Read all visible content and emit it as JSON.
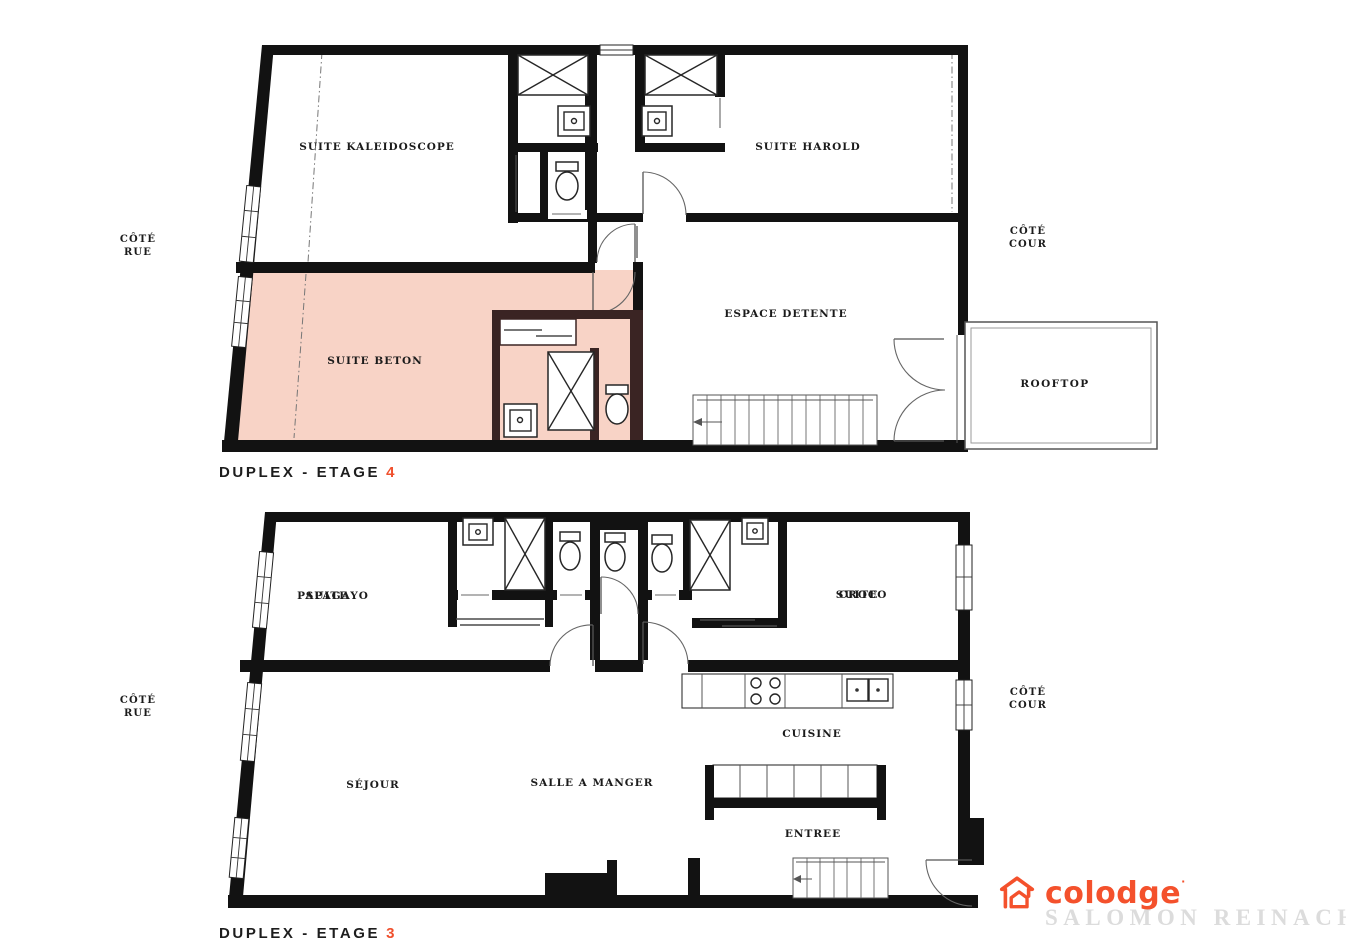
{
  "colors": {
    "accent": "#F0502D",
    "suite_highlight": "#F8D3C6",
    "beton_label": "#E84F35",
    "suite_name_accent": "#7B2025",
    "logo_orange": "#F4512C",
    "residence_gray": "#DCDCDC"
  },
  "floor4": {
    "title_prefix": "DUPLEX - ETAGE",
    "title_number": "4",
    "side_left_line1": "CÔTÉ",
    "side_left_line2": "RUE",
    "side_right_line1": "CÔTÉ",
    "side_right_line2": "COUR",
    "rooms": {
      "kaleidoscope": "SUITE KALEIDOSCOPE",
      "harold": "SUITE HAROLD",
      "beton": "SUITE BETON",
      "espace_detente": "ESPACE DETENTE",
      "rooftop": "ROOFTOP"
    }
  },
  "floor3": {
    "title_prefix": "DUPLEX - ETAGE",
    "title_number": "3",
    "side_left_line1": "CÔTÉ",
    "side_left_line2": "RUE",
    "side_right_line1": "CÔTÉ",
    "side_right_line2": "COUR",
    "rooms": {
      "papagayo_prefix": "SUITE",
      "papagayo_name": "PAPAGAYO",
      "croco_prefix": "SUITE",
      "croco_name": "CROCO",
      "sejour": "SÉJOUR",
      "salle_a_manger": "SALLE A MANGER",
      "cuisine": "CUISINE",
      "entree": "ENTREE"
    }
  },
  "logo": {
    "brand": "colodge",
    "mark": "·",
    "residence": "SALOMON REINACH"
  }
}
